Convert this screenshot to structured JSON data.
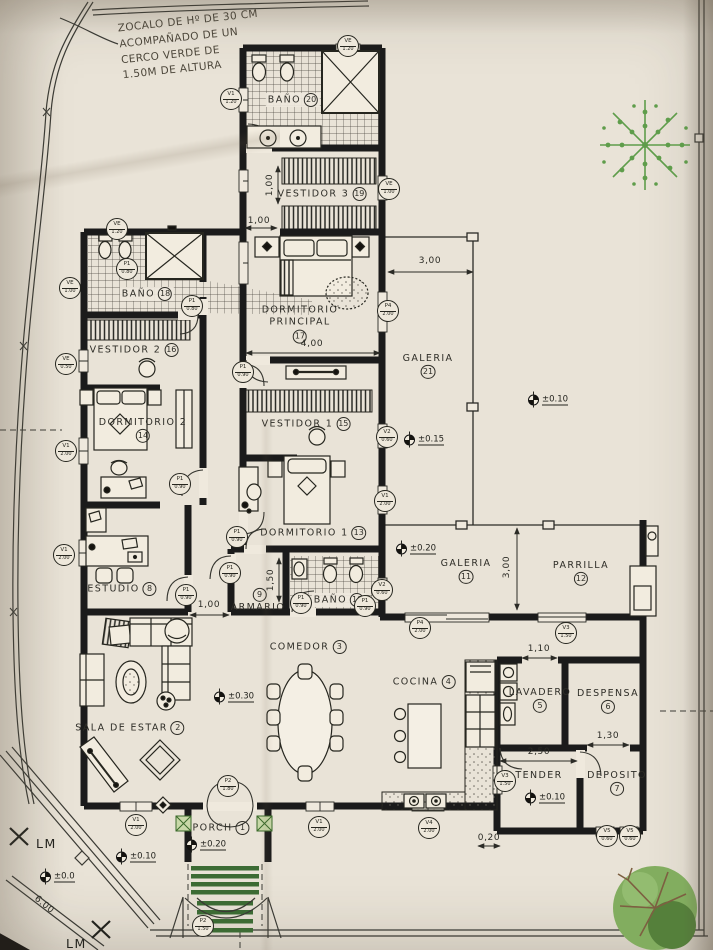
{
  "drawing": {
    "type": "architectural-floor-plan",
    "note": {
      "lines": [
        "ZOCALO DE Hº DE 30 CM",
        "ACOMPAÑADO DE UN",
        "CERCO VERDE DE",
        "1.50M DE ALTURA"
      ]
    },
    "colors": {
      "paper": "#e9e3d7",
      "ink": "#1b1b1b",
      "tree_green": "#5f9d4b",
      "step_green": "#3c6b34",
      "planter_green": "#c8d8a8"
    }
  },
  "rooms": [
    {
      "line1": "BAÑO",
      "num": "20",
      "x": 293,
      "y": 100,
      "numpos": "inline",
      "bg": true
    },
    {
      "line1": "VESTIDOR 3",
      "num": "19",
      "x": 322,
      "y": 194,
      "numpos": "inline"
    },
    {
      "line1": "DORMITORIO",
      "line2": "PRINCIPAL",
      "num": "17",
      "x": 300,
      "y": 324,
      "numpos": "below"
    },
    {
      "line1": "GALERIA",
      "num": "21",
      "x": 428,
      "y": 366,
      "numpos": "below"
    },
    {
      "line1": "BAÑO",
      "num": "18",
      "x": 147,
      "y": 294,
      "numpos": "inline",
      "bg": true
    },
    {
      "line1": "VESTIDOR 2",
      "num": "16",
      "x": 134,
      "y": 350,
      "numpos": "inline"
    },
    {
      "line1": "DORMITORIO 2",
      "num": "14",
      "x": 143,
      "y": 430,
      "numpos": "below"
    },
    {
      "line1": "VESTIDOR 1",
      "num": "15",
      "x": 306,
      "y": 424,
      "numpos": "inline"
    },
    {
      "line1": "DORMITORIO 1",
      "num": "13",
      "x": 313,
      "y": 533,
      "numpos": "inline"
    },
    {
      "line1": "ESTUDIO",
      "num": "8",
      "x": 122,
      "y": 589,
      "numpos": "inline"
    },
    {
      "line1": "ARMARIO",
      "num": "9",
      "x": 258,
      "y": 601,
      "numpos": "above"
    },
    {
      "line1": "BAÑO",
      "num": "10",
      "x": 339,
      "y": 600,
      "numpos": "inline",
      "bg": true
    },
    {
      "line1": "GALERIA",
      "num": "11",
      "x": 466,
      "y": 571,
      "numpos": "below"
    },
    {
      "line1": "PARRILLA",
      "num": "12",
      "x": 581,
      "y": 573,
      "numpos": "below"
    },
    {
      "line1": "COMEDOR",
      "num": "3",
      "x": 308,
      "y": 647,
      "numpos": "inline"
    },
    {
      "line1": "COCINA",
      "num": "4",
      "x": 424,
      "y": 682,
      "numpos": "inline"
    },
    {
      "line1": "LAVADERO",
      "num": "5",
      "x": 540,
      "y": 700,
      "numpos": "below"
    },
    {
      "line1": "DESPENSA",
      "num": "6",
      "x": 608,
      "y": 701,
      "numpos": "below"
    },
    {
      "line1": "TENDER",
      "num": "",
      "x": 539,
      "y": 776,
      "numpos": "none"
    },
    {
      "line1": "DEPOSITO",
      "num": "7",
      "x": 617,
      "y": 783,
      "numpos": "below"
    },
    {
      "line1": "SALA DE ESTAR",
      "num": "2",
      "x": 130,
      "y": 728,
      "numpos": "inline"
    },
    {
      "line1": "PORCH",
      "num": "1",
      "x": 221,
      "y": 828,
      "numpos": "inline"
    }
  ],
  "dimensions": [
    {
      "t": "3,00",
      "x": 430,
      "y": 261,
      "rot": 0
    },
    {
      "t": "4,00",
      "x": 312,
      "y": 344,
      "rot": 0
    },
    {
      "t": "1,00",
      "x": 270,
      "y": 185,
      "rot": -90
    },
    {
      "t": "1,00",
      "x": 259,
      "y": 221,
      "rot": 0
    },
    {
      "t": "3,00",
      "x": 507,
      "y": 567,
      "rot": -90
    },
    {
      "t": "1,50",
      "x": 271,
      "y": 580,
      "rot": -90
    },
    {
      "t": "1,00",
      "x": 209,
      "y": 605,
      "rot": 0
    },
    {
      "t": "1,10",
      "x": 539,
      "y": 649,
      "rot": 0
    },
    {
      "t": "2,50",
      "x": 539,
      "y": 752,
      "rot": 0
    },
    {
      "t": "1,30",
      "x": 608,
      "y": 736,
      "rot": 0
    },
    {
      "t": "0,20",
      "x": 489,
      "y": 838,
      "rot": 0
    },
    {
      "t": "6.00",
      "x": 44,
      "y": 905,
      "rot": 40
    }
  ],
  "levels": [
    {
      "t": "±0.10",
      "x": 528,
      "y": 400
    },
    {
      "t": "±0.15",
      "x": 404,
      "y": 440
    },
    {
      "t": "±0.20",
      "x": 396,
      "y": 549
    },
    {
      "t": "±0.30",
      "x": 214,
      "y": 697
    },
    {
      "t": "±0.10",
      "x": 525,
      "y": 798
    },
    {
      "t": "±0.20",
      "x": 186,
      "y": 845
    },
    {
      "t": "±0.10",
      "x": 116,
      "y": 857
    },
    {
      "t": "±0.0",
      "x": 40,
      "y": 877
    }
  ],
  "tags": [
    {
      "a": "VE",
      "b": "1.20",
      "x": 348,
      "y": 46
    },
    {
      "a": "V1",
      "b": "1.20",
      "x": 231,
      "y": 99
    },
    {
      "a": "VE",
      "b": "1.00",
      "x": 389,
      "y": 189
    },
    {
      "a": "P1",
      "b": "0.90",
      "x": 243,
      "y": 372
    },
    {
      "a": "VE",
      "b": "1.20",
      "x": 117,
      "y": 229
    },
    {
      "a": "VE",
      "b": "1.00",
      "x": 70,
      "y": 288
    },
    {
      "a": "P1",
      "b": "0.80",
      "x": 127,
      "y": 269
    },
    {
      "a": "P1",
      "b": "0.80",
      "x": 192,
      "y": 306
    },
    {
      "a": "VE",
      "b": "0.50",
      "x": 66,
      "y": 364
    },
    {
      "a": "V1",
      "b": "2.00",
      "x": 66,
      "y": 451
    },
    {
      "a": "P4",
      "b": "2.00",
      "x": 388,
      "y": 311
    },
    {
      "a": "V2",
      "b": "0.60",
      "x": 387,
      "y": 437
    },
    {
      "a": "V1",
      "b": "2.00",
      "x": 385,
      "y": 501
    },
    {
      "a": "V2",
      "b": "0.60",
      "x": 382,
      "y": 590
    },
    {
      "a": "P1",
      "b": "0.90",
      "x": 180,
      "y": 484
    },
    {
      "a": "V1",
      "b": "2.00",
      "x": 64,
      "y": 555
    },
    {
      "a": "P1",
      "b": "0.90",
      "x": 186,
      "y": 595
    },
    {
      "a": "P1",
      "b": "0.90",
      "x": 230,
      "y": 573
    },
    {
      "a": "P1",
      "b": "0.90",
      "x": 301,
      "y": 603
    },
    {
      "a": "P1",
      "b": "0.90",
      "x": 237,
      "y": 537
    },
    {
      "a": "P1",
      "b": "0.90",
      "x": 365,
      "y": 606
    },
    {
      "a": "P4",
      "b": "2.00",
      "x": 420,
      "y": 628
    },
    {
      "a": "V3",
      "b": "1.50",
      "x": 566,
      "y": 633
    },
    {
      "a": "V3",
      "b": "1.50",
      "x": 505,
      "y": 781
    },
    {
      "a": "V4",
      "b": "2.00",
      "x": 429,
      "y": 828
    },
    {
      "a": "V5",
      "b": "0.60",
      "x": 607,
      "y": 836
    },
    {
      "a": "V5",
      "b": "0.60",
      "x": 630,
      "y": 836
    },
    {
      "a": "P2",
      "b": "1.80",
      "x": 228,
      "y": 786
    },
    {
      "a": "V1",
      "b": "2.00",
      "x": 319,
      "y": 827
    },
    {
      "a": "V1",
      "b": "2.00",
      "x": 136,
      "y": 825
    },
    {
      "a": "P2",
      "b": "1.50",
      "x": 203,
      "y": 926
    }
  ],
  "lm_marks": [
    {
      "t": "LM",
      "x": 36,
      "y": 836
    },
    {
      "t": "LM",
      "x": 66,
      "y": 936
    }
  ]
}
